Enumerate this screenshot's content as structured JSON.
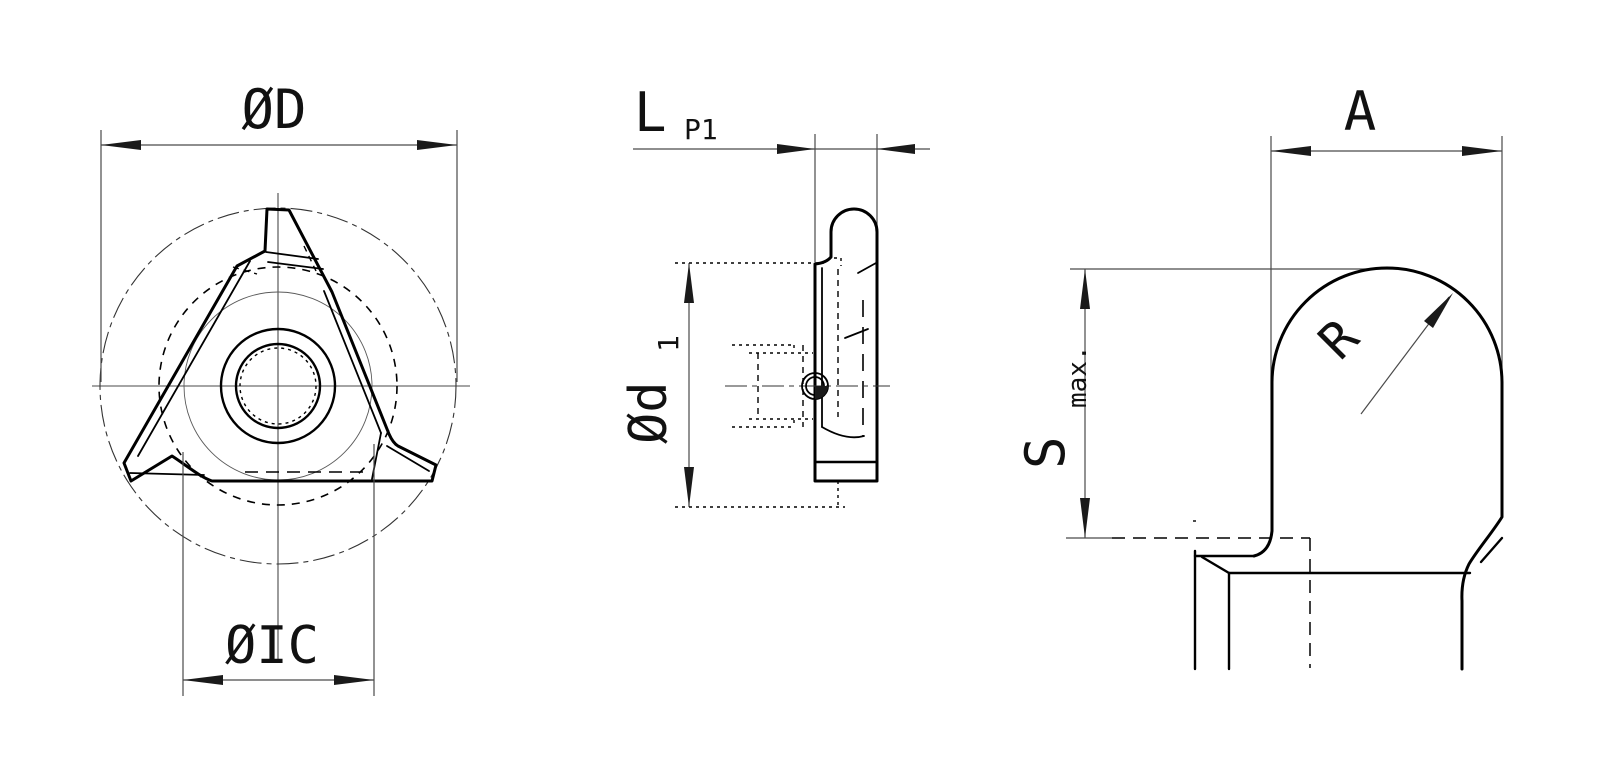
{
  "drawing": {
    "background": "#ffffff",
    "outline_color": "#000000",
    "dimension_line_color": "#4a4a4a",
    "labels": {
      "front_outer_diameter": "ØD",
      "front_inscribed_circle": "ØIC",
      "side_length": "L",
      "side_pitch": "P1",
      "side_diameter": "Ød",
      "side_diameter_sub": "1",
      "detail_width": "A",
      "detail_radius": "R",
      "detail_depth": "S",
      "detail_depth_suffix": "max."
    }
  }
}
